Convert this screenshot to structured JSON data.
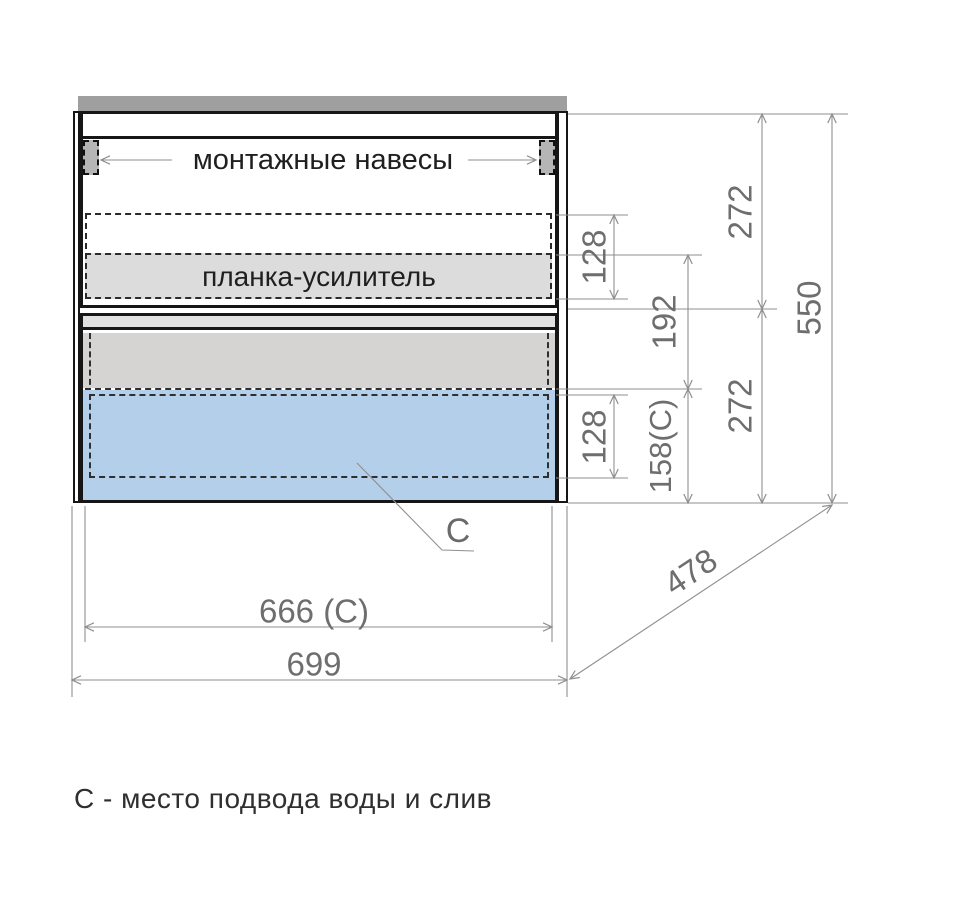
{
  "labels": {
    "mounting_hangers": "монтажные навесы",
    "reinforcement_bar": "планка-усилитель",
    "c_marker": "C",
    "note": "С - место подвода воды и слив"
  },
  "dimensions": {
    "hanger_zone_height": "128",
    "offset_to_bar": "192",
    "top_section_height": "272",
    "drain_zone_height": "158(C)",
    "bottom_section_height": "272",
    "total_height": "550",
    "drain_inner_height": "128",
    "inner_width": "666 (C)",
    "total_width": "699",
    "depth": "478"
  },
  "colors": {
    "countertop": "#9f9f9f",
    "hanger": "#b5b5b5",
    "reinforcement_fill": "#dcdcdc",
    "drawer_fill": "#d6d4d2",
    "water_zone": "#b3cfe9",
    "dim_line": "#8f8f8f",
    "dim_text": "#6e6e6e",
    "outline": "#161616"
  }
}
